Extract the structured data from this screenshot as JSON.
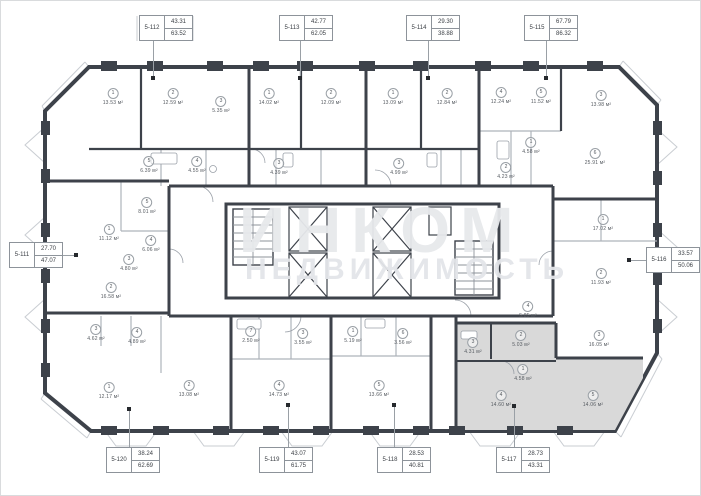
{
  "watermark": {
    "line1": "ИНКОМ",
    "line2": "НЕДВИЖИМОСТЬ"
  },
  "colors": {
    "wall": "#3d424a",
    "partition": "#aeb3ba",
    "balcony": "#c9cdd2",
    "highlight": "#d9d9d9",
    "label_border": "#8d939a",
    "text": "#3c4046",
    "watermark": "#e7e9ec"
  },
  "units": [
    {
      "id": "5-112",
      "area1": "43.31",
      "area2": "63.52",
      "x": 138,
      "y": 14,
      "lx": 152,
      "dot": [
        152,
        77
      ],
      "dir": "down"
    },
    {
      "id": "5-113",
      "area1": "42.77",
      "area2": "62.05",
      "x": 278,
      "y": 14,
      "lx": 299,
      "dot": [
        299,
        77
      ],
      "dir": "down"
    },
    {
      "id": "5-114",
      "area1": "29.30",
      "area2": "38.88",
      "x": 405,
      "y": 14,
      "lx": 427,
      "dot": [
        427,
        77
      ],
      "dir": "down"
    },
    {
      "id": "5-115",
      "area1": "67.79",
      "area2": "86.32",
      "x": 523,
      "y": 14,
      "lx": 545,
      "dot": [
        545,
        77
      ],
      "dir": "down"
    },
    {
      "id": "5-111",
      "area1": "27.70",
      "area2": "47.07",
      "x": 8,
      "y": 241,
      "lx": 254,
      "dot": [
        75,
        254
      ],
      "dir": "right"
    },
    {
      "id": "5-116",
      "area1": "33.57",
      "area2": "50.06",
      "x": 645,
      "y": 246,
      "lx": 259,
      "dot": [
        628,
        259
      ],
      "dir": "left"
    },
    {
      "id": "5-120",
      "area1": "38.24",
      "area2": "62.69",
      "x": 105,
      "y": 446,
      "lx": 128,
      "dot": [
        128,
        408
      ],
      "dir": "up"
    },
    {
      "id": "5-119",
      "area1": "43.07",
      "area2": "61.75",
      "x": 258,
      "y": 446,
      "lx": 287,
      "dot": [
        287,
        404
      ],
      "dir": "up"
    },
    {
      "id": "5-118",
      "area1": "28.53",
      "area2": "40.81",
      "x": 376,
      "y": 446,
      "lx": 393,
      "dot": [
        393,
        404
      ],
      "dir": "up"
    },
    {
      "id": "5-117",
      "area1": "28.73",
      "area2": "43.31",
      "x": 495,
      "y": 446,
      "lx": 513,
      "dot": [
        513,
        405
      ],
      "dir": "up"
    }
  ],
  "rooms": [
    {
      "n": "1",
      "area": "13.53 м²",
      "x": 112,
      "y": 96
    },
    {
      "n": "2",
      "area": "12.59 м²",
      "x": 172,
      "y": 96
    },
    {
      "n": "3",
      "area": "5.35 м²",
      "x": 220,
      "y": 104
    },
    {
      "n": "5",
      "area": "6.39 м²",
      "x": 148,
      "y": 164
    },
    {
      "n": "4",
      "area": "4.55 м²",
      "x": 196,
      "y": 164
    },
    {
      "n": "1",
      "area": "14.02 м²",
      "x": 268,
      "y": 96
    },
    {
      "n": "2",
      "area": "12.09 м²",
      "x": 330,
      "y": 96
    },
    {
      "n": "3",
      "area": "4.39 м²",
      "x": 278,
      "y": 166
    },
    {
      "n": "1",
      "area": "13.09 м²",
      "x": 392,
      "y": 96
    },
    {
      "n": "2",
      "area": "12.84 м²",
      "x": 446,
      "y": 96
    },
    {
      "n": "3",
      "area": "4.99 м²",
      "x": 398,
      "y": 166
    },
    {
      "n": "4",
      "area": "12.24 м²",
      "x": 500,
      "y": 95
    },
    {
      "n": "5",
      "area": "11.52 м²",
      "x": 540,
      "y": 95
    },
    {
      "n": "3",
      "area": "13.98 м²",
      "x": 600,
      "y": 98
    },
    {
      "n": "1",
      "area": "4.58 м²",
      "x": 530,
      "y": 145
    },
    {
      "n": "2",
      "area": "4.23 м²",
      "x": 505,
      "y": 170
    },
    {
      "n": "6",
      "area": "25.91 м²",
      "x": 594,
      "y": 156
    },
    {
      "n": "1",
      "area": "17.02 м²",
      "x": 602,
      "y": 222
    },
    {
      "n": "2",
      "area": "11.93 м²",
      "x": 600,
      "y": 276
    },
    {
      "n": "3",
      "area": "16.05 м²",
      "x": 598,
      "y": 338
    },
    {
      "n": "4",
      "area": "5.85 м²",
      "x": 527,
      "y": 309
    },
    {
      "n": "5",
      "area": "8.01 м²",
      "x": 146,
      "y": 205
    },
    {
      "n": "1",
      "area": "11.12 м²",
      "x": 108,
      "y": 232
    },
    {
      "n": "4",
      "area": "6.06 м²",
      "x": 150,
      "y": 243
    },
    {
      "n": "3",
      "area": "4.80 м²",
      "x": 128,
      "y": 262
    },
    {
      "n": "2",
      "area": "16.58 м²",
      "x": 110,
      "y": 290
    },
    {
      "n": "3",
      "area": "4.62 м²",
      "x": 95,
      "y": 332
    },
    {
      "n": "4",
      "area": "4.89 м²",
      "x": 136,
      "y": 335
    },
    {
      "n": "1",
      "area": "12.17 м²",
      "x": 108,
      "y": 390
    },
    {
      "n": "2",
      "area": "13.08 м²",
      "x": 188,
      "y": 388
    },
    {
      "n": "7",
      "area": "2.50 м²",
      "x": 250,
      "y": 334
    },
    {
      "n": "3",
      "area": "3.55 м²",
      "x": 302,
      "y": 336
    },
    {
      "n": "4",
      "area": "14.73 м²",
      "x": 278,
      "y": 388
    },
    {
      "n": "1",
      "area": "5.19 м²",
      "x": 352,
      "y": 334
    },
    {
      "n": "6",
      "area": "3.56 м²",
      "x": 402,
      "y": 336
    },
    {
      "n": "5",
      "area": "13.66 м²",
      "x": 378,
      "y": 388
    },
    {
      "n": "2",
      "area": "5.03 м²",
      "x": 520,
      "y": 338
    },
    {
      "n": "3",
      "area": "4.31 м²",
      "x": 472,
      "y": 345
    },
    {
      "n": "1",
      "area": "4.58 м²",
      "x": 522,
      "y": 372
    },
    {
      "n": "4",
      "area": "14.60 м²",
      "x": 500,
      "y": 398
    },
    {
      "n": "5",
      "area": "14.06 м²",
      "x": 592,
      "y": 398
    }
  ]
}
